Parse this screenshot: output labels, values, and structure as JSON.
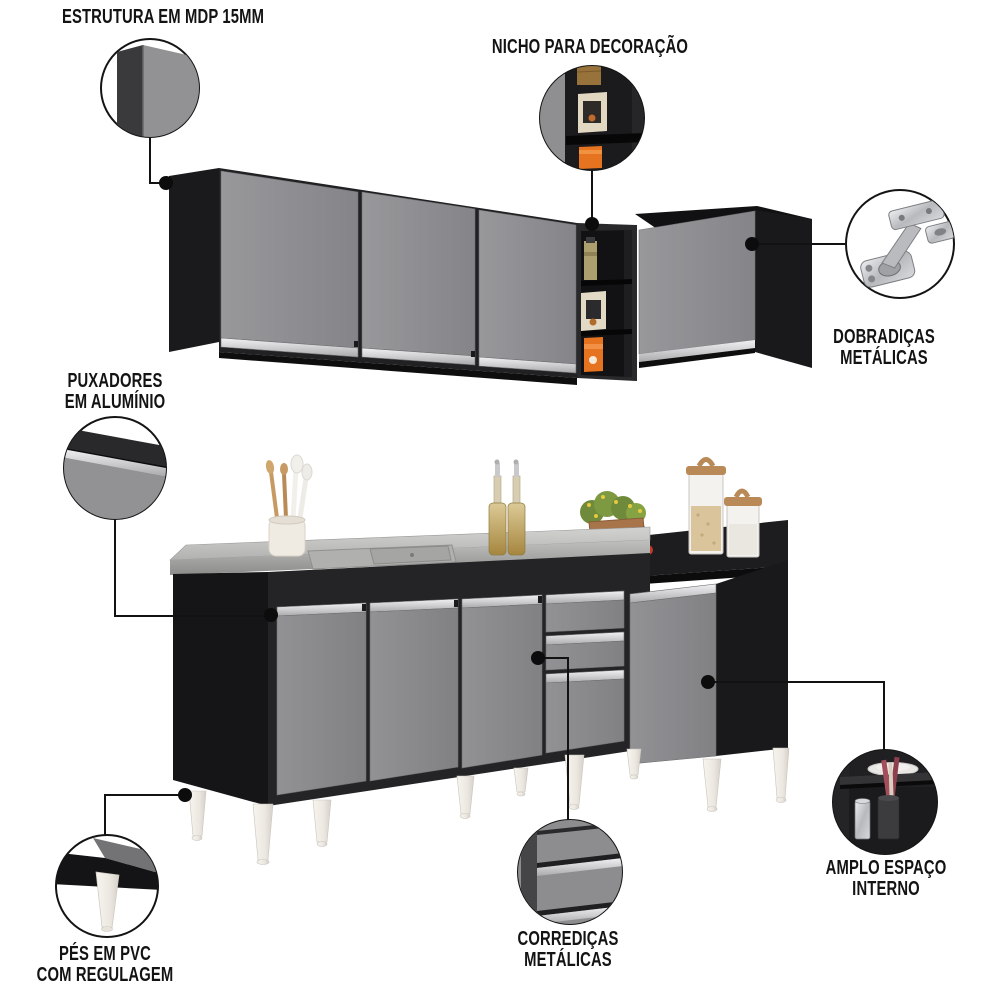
{
  "colors": {
    "background": "#ffffff",
    "cabinet_black": "#1f1f21",
    "door_gray": "#8c8c8e",
    "aluminum_silver": "#d6d6d8",
    "steel_counter": "#b5b5b3",
    "foot_white": "#efece6",
    "accent_orange": "#e5731f",
    "callout_line": "#121212"
  },
  "callouts": [
    {
      "id": "estrutura",
      "icon": "panel-corner-detail",
      "label_lines": [
        "ESTRUTURA EM MDP 15MM"
      ]
    },
    {
      "id": "nicho",
      "icon": "niche-shelves-detail",
      "label_lines": [
        "NICHO PARA DECORAÇÃO"
      ]
    },
    {
      "id": "dobradicas",
      "icon": "metal-hinge-detail",
      "label_lines": [
        "DOBRADIÇAS",
        "METÁLICAS"
      ]
    },
    {
      "id": "puxadores",
      "icon": "aluminum-handle-detail",
      "label_lines": [
        "PUXADORES",
        "EM ALUMÍNIO"
      ]
    },
    {
      "id": "pes",
      "icon": "pvc-foot-detail",
      "label_lines": [
        "PÉS EM PVC",
        "COM REGULAGEM"
      ]
    },
    {
      "id": "corredicas",
      "icon": "drawer-slide-detail",
      "label_lines": [
        "CORREDIÇAS",
        "METÁLICAS"
      ]
    },
    {
      "id": "amplo",
      "icon": "interior-space-detail",
      "label_lines": [
        "AMPLO ESPAÇO",
        "INTERNO"
      ]
    }
  ]
}
